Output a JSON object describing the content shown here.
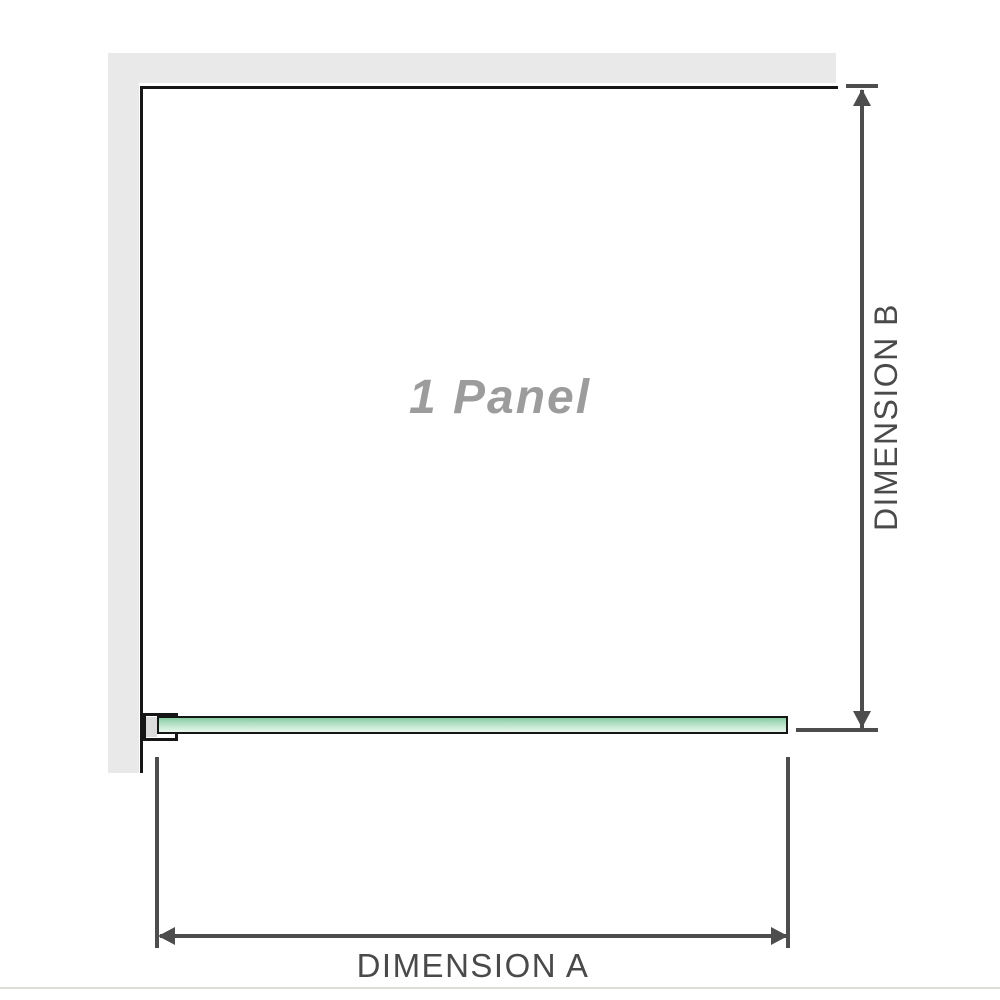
{
  "diagram": {
    "panel_label": "1 Panel",
    "dimension_a": {
      "label": "DIMENSION A"
    },
    "dimension_b": {
      "label": "DIMENSION B"
    },
    "colors": {
      "wall_gray": "#e9e9e9",
      "outline_black": "#161616",
      "dimension_line_gray": "#4d4d4d",
      "label_text_gray": "#4a4a4a",
      "panel_label_gray": "#9c9c9c",
      "glass_green_top": "#86cda2",
      "glass_green_bottom": "#e9f7ee",
      "bracket_inset_gray": "#dcdcdc",
      "bottom_edge_gray": "#dcdcd8"
    }
  }
}
